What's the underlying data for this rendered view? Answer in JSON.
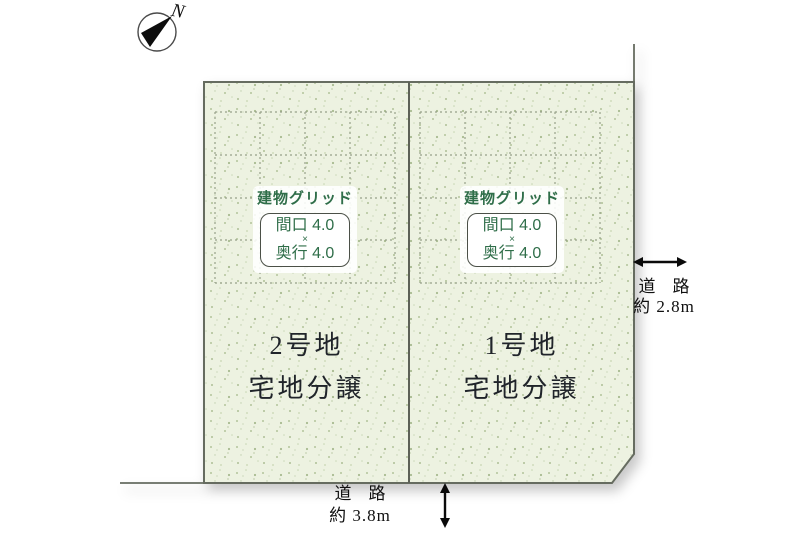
{
  "compass": {
    "label": "N"
  },
  "plots": [
    {
      "name": "2号地",
      "category": "宅地分譲",
      "building_grid": {
        "title": "建物グリッド",
        "frontage": "間口 4.0",
        "multiply": "×",
        "depth": "奥行 4.0"
      }
    },
    {
      "name": "1号地",
      "category": "宅地分譲",
      "building_grid": {
        "title": "建物グリッド",
        "frontage": "間口 4.0",
        "multiply": "×",
        "depth": "奥行 4.0"
      }
    }
  ],
  "roads": {
    "right": {
      "label": "道　路",
      "width_label": "約 2.8m"
    },
    "bottom": {
      "label": "道　路",
      "width_label": "約 3.8m"
    }
  },
  "colors": {
    "plot_fill": "#edf2e1",
    "plot_border": "#666c60",
    "grid_dash": "#97a189",
    "accent_green": "#2f6e49",
    "text_dark": "#20242a",
    "arrow_black": "#0a0a0a"
  }
}
